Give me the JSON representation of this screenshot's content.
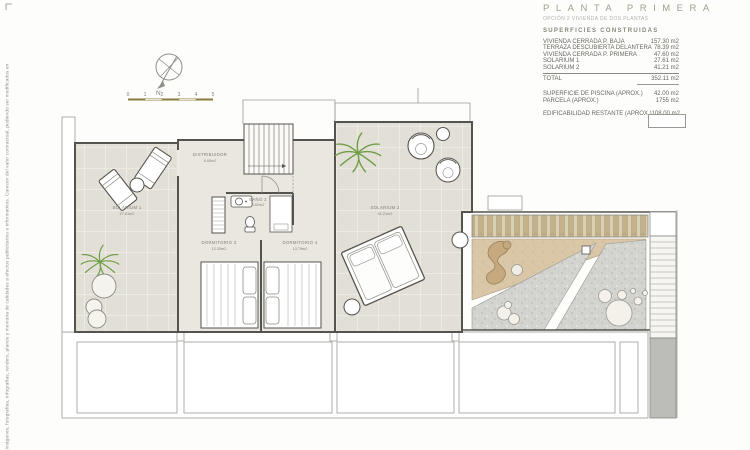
{
  "disclaimer": "Imágenes, fotografías, infografías, renders, planos y memoria de calidades a efectos publicitarios e informativos. Carecen del valor contractual, pudiendo ser modificados en",
  "title_block": {
    "title": "PLANTA PRIMERA",
    "subtitle": "OPCIÓN 2 VIVIENDA DE DOS PLANTAS",
    "section": "SUPERFICIES CONSTRUIDAS",
    "rows": [
      {
        "label": "VIVIENDA CERRADA P. BAJA",
        "value": "157.30 m2"
      },
      {
        "label": "TERRAZA DESCUBIERTA DELANTERA",
        "value": "78.39 m2"
      },
      {
        "label": "VIVIENDA CERRADA P. PRIMERA",
        "value": "47.60 m2"
      },
      {
        "label": "SOLARIUM 1",
        "value": "27.61 m2"
      },
      {
        "label": "SOLARIUM 2",
        "value": "41.21 m2"
      }
    ],
    "total_label": "TOTAL",
    "total_value": "352.11 m2",
    "extra_rows": [
      {
        "label": "SUPERFICIE DE PISCINA   (APROX.)",
        "value": "42.00 m2"
      },
      {
        "label": "PARCELA   (APROX.)",
        "value": "1755 m2"
      }
    ],
    "footer_row": {
      "label": "EDIFICABILIDAD RESTANTE   (APROX.)",
      "value": "108.00 m2"
    }
  },
  "compass": {
    "north_label": "N"
  },
  "scale_bar": {
    "labels": [
      "0",
      "1",
      "2",
      "3",
      "4",
      "5"
    ]
  },
  "plan": {
    "solarium1": {
      "name": "SOLARIUM 1",
      "area": "27.61m2"
    },
    "distribuidor": {
      "name": "DISTRIBUIDOR",
      "area": "5.00m2"
    },
    "bano2": {
      "name": "BAÑO 2",
      "area": "3.52m2"
    },
    "dormitorio3": {
      "name": "DORMITORIO 3",
      "area": "12.20m2"
    },
    "dormitorio4": {
      "name": "DORMITORIO 4",
      "area": "13.79m2"
    },
    "solarium2": {
      "name": "SOLARIUM 2",
      "area": "41.21m2"
    }
  },
  "colors": {
    "title_accent": "#9ba38f",
    "scale_text": "#8a7b3a",
    "wall": "#55534e",
    "tile_floor": "#e2dfd6",
    "sand": "#dac7a7",
    "wood_slat": "#c3b18b",
    "gravel": "#d3d3cf",
    "palm_green": "#6f9e46",
    "stair_gray": "#bcbcb8"
  }
}
